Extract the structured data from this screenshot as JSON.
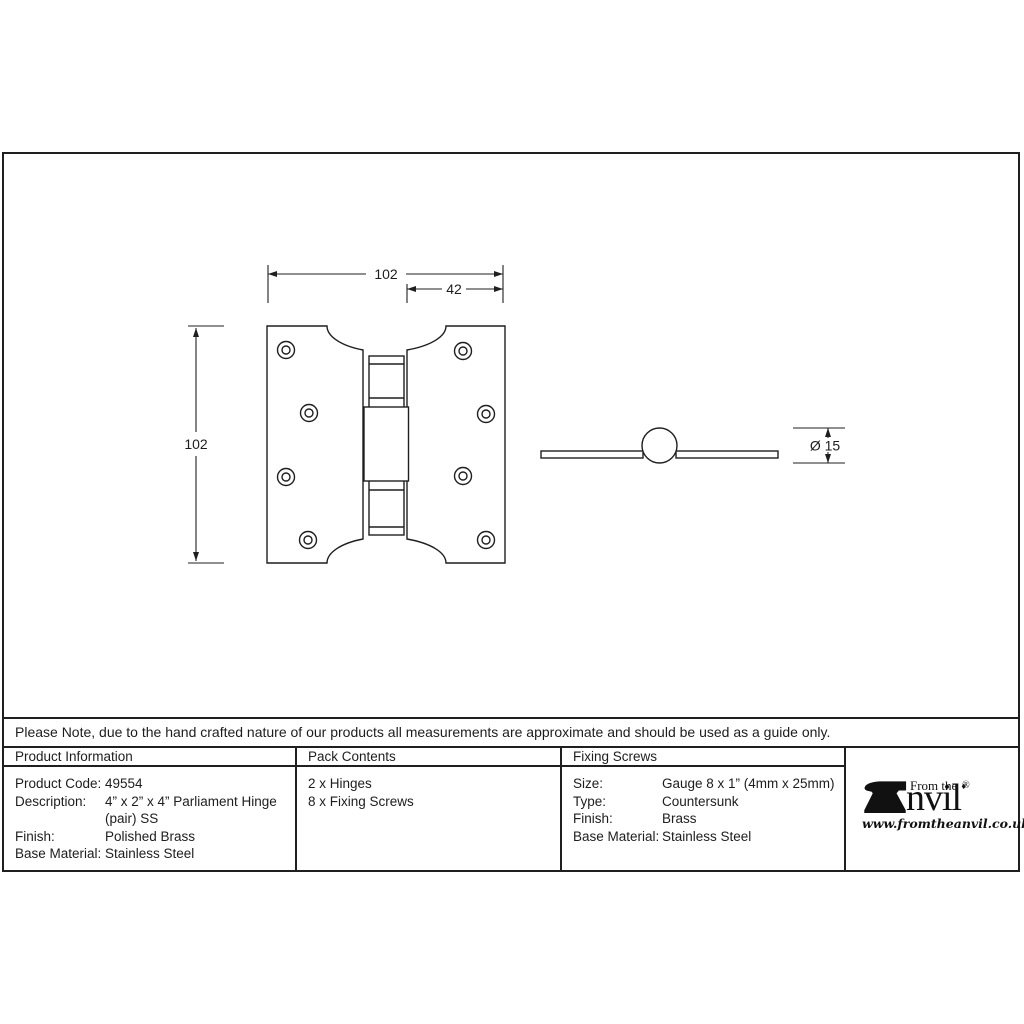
{
  "note": "Please Note, due to the hand crafted nature of our products all measurements are approximate and should be used as a guide only.",
  "drawing": {
    "front_view": {
      "width_label": "102",
      "offset_label": "42",
      "height_label": "102"
    },
    "side_view": {
      "diameter_label": "Ø 15"
    }
  },
  "table": {
    "product_information": {
      "header": "Product Information",
      "rows": [
        {
          "label": "Product Code:",
          "value": "49554"
        },
        {
          "label": "Description:",
          "value": "4” x 2” x 4” Parliament Hinge (pair) SS"
        },
        {
          "label": "Finish:",
          "value": "Polished Brass"
        },
        {
          "label": "Base Material:",
          "value": "Stainless Steel"
        }
      ]
    },
    "pack_contents": {
      "header": "Pack Contents",
      "items": [
        "2 x Hinges",
        "8 x Fixing Screws"
      ]
    },
    "fixing_screws": {
      "header": "Fixing Screws",
      "rows": [
        {
          "label": "Size:",
          "value": "Gauge 8 x 1” (4mm x 25mm)"
        },
        {
          "label": "Type:",
          "value": "Countersunk"
        },
        {
          "label": "Finish:",
          "value": "Brass"
        },
        {
          "label": "Base Material:",
          "value": "Stainless Steel"
        }
      ]
    }
  },
  "logo": {
    "prefix": "From the",
    "separator": "♦",
    "name_rest": "nvil",
    "registered": "®",
    "website": "www.fromtheanvil.co.uk"
  },
  "colors": {
    "line": "#1f1f1f",
    "background": "#ffffff"
  }
}
